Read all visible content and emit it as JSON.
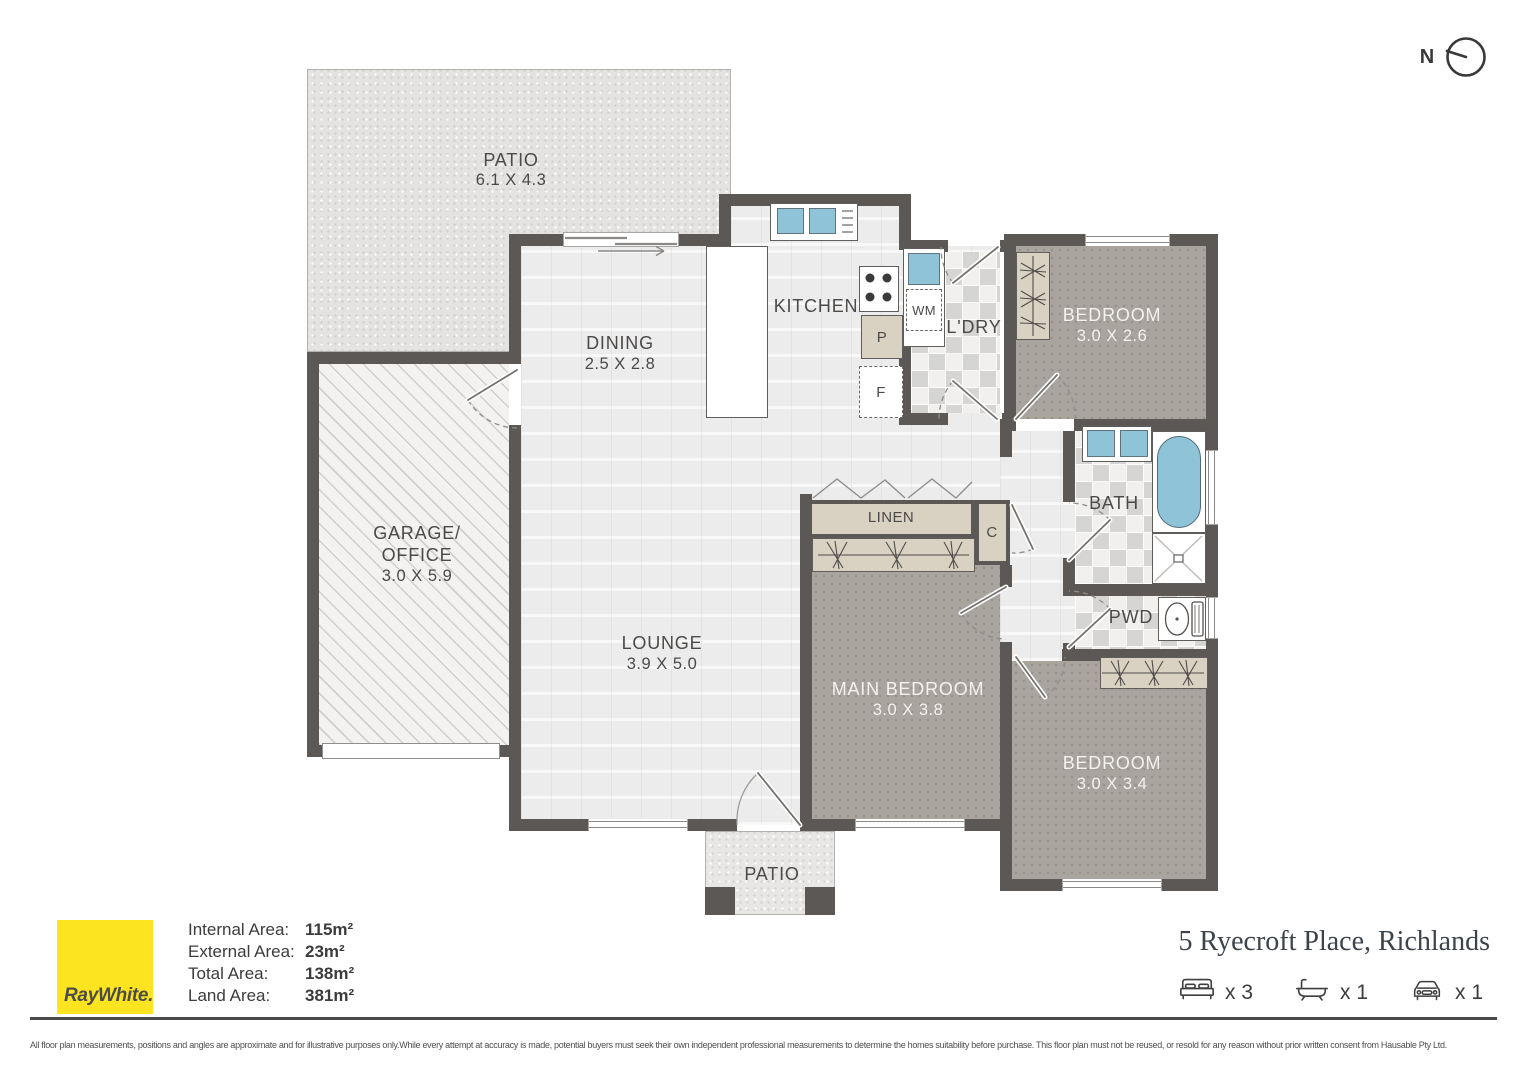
{
  "north_label": "N",
  "plan": {
    "rooms": {
      "patio_top": {
        "name": "PATIO",
        "dims": "6.1 X 4.3"
      },
      "dining": {
        "name": "DINING",
        "dims": "2.5 X 2.8"
      },
      "kitchen": {
        "name": "KITCHEN"
      },
      "laundry": {
        "name": "L'DRY"
      },
      "bedroom1": {
        "name": "BEDROOM",
        "dims": "3.0 X 2.6"
      },
      "bath": {
        "name": "BATH"
      },
      "linen": {
        "name": "LINEN"
      },
      "cupboard": {
        "name": "C"
      },
      "garage": {
        "line1": "GARAGE/",
        "line2": "OFFICE",
        "dims": "3.0 X 5.9"
      },
      "lounge": {
        "name": "LOUNGE",
        "dims": "3.9 X 5.0"
      },
      "main_bedroom": {
        "name": "MAIN BEDROOM",
        "dims": "3.0 X 3.8"
      },
      "pwd": {
        "name": "PWD"
      },
      "bedroom2": {
        "name": "BEDROOM",
        "dims": "3.0 X 3.4"
      },
      "patio_bottom": {
        "name": "PATIO"
      }
    },
    "fixtures": {
      "washing_machine": "WM",
      "pantry": "P",
      "fridge": "F"
    }
  },
  "footer": {
    "brand": "RayWhite.",
    "areas": [
      {
        "label": "Internal Area:",
        "value": "115m²"
      },
      {
        "label": "External Area:",
        "value": "23m²"
      },
      {
        "label": "Total Area:",
        "value": "138m²"
      },
      {
        "label": "Land Area:",
        "value": "381m²"
      }
    ],
    "address": "5 Ryecroft Place, Richlands",
    "features": [
      {
        "icon": "bed-icon",
        "count": "x 3"
      },
      {
        "icon": "bath-icon",
        "count": "x 1"
      },
      {
        "icon": "car-icon",
        "count": "x 1"
      }
    ],
    "disclaimer": "All floor plan measurements, positions and angles are approximate and for illustrative purposes only.While every attempt at accuracy is made, potential buyers must seek their own independent professional measurements to determine the homes suitability before purchase. This floor plan must not be reused, or resold for any reason without prior written consent from Hausable Pty Ltd."
  },
  "colors": {
    "wall": "#5b5855",
    "ray_white_yellow": "#fde420",
    "water_blue": "#8fc3d8",
    "bedroom_floor": "#a9a49d",
    "cabinet_tan": "#d9d2c3"
  }
}
